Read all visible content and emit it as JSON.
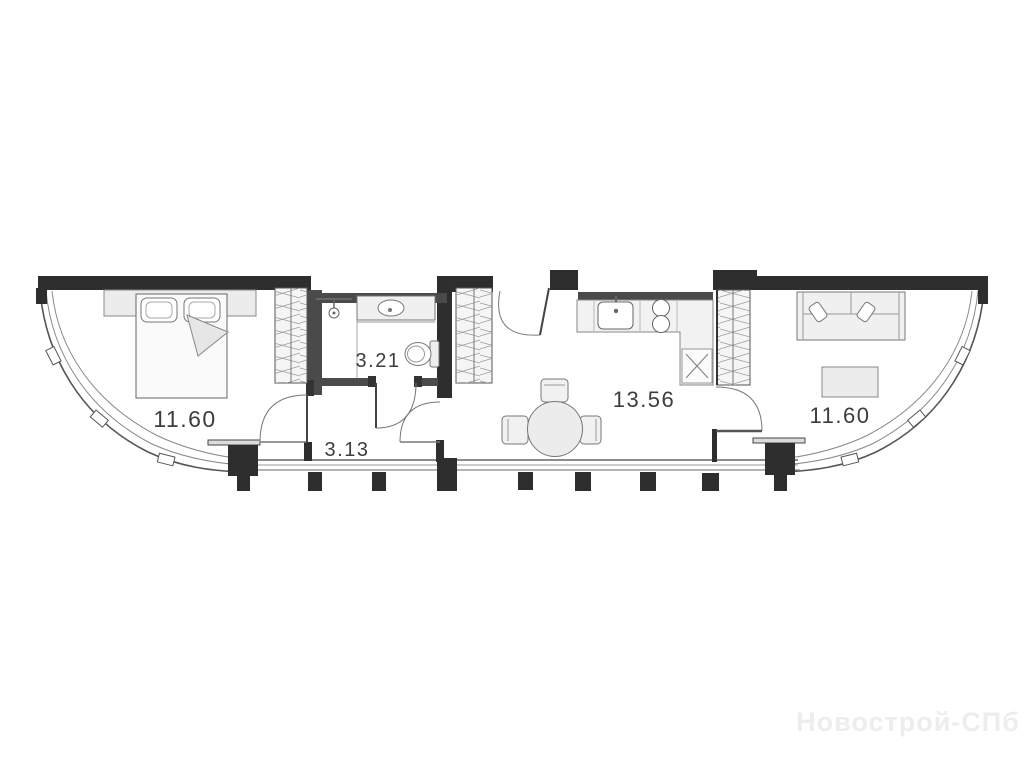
{
  "plan": {
    "type": "apartment-floor-plan",
    "rooms": [
      {
        "id": "bedroom",
        "area": "11.60"
      },
      {
        "id": "bathroom",
        "area": "3.21"
      },
      {
        "id": "hallway",
        "area": "3.13"
      },
      {
        "id": "kitchen_living",
        "area": "13.56"
      },
      {
        "id": "living_room",
        "area": "11.60"
      }
    ],
    "furniture": [
      "bed",
      "wardrobe",
      "shower",
      "vanity-sink",
      "toilet",
      "kitchen-counter",
      "kitchen-sink",
      "stove",
      "appliance-x",
      "dining-table",
      "chairs",
      "sofa",
      "coffee-table"
    ]
  },
  "labels": {
    "bedroom_area": "11.60",
    "bathroom_area": "3.21",
    "hallway_area": "3.13",
    "kitchen_area": "13.56",
    "living_area": "11.60"
  },
  "watermark": {
    "text": "Новострой-СПб"
  },
  "colors": {
    "wall_black": "#2e2e2e",
    "wall_gray": "#4a4a4a",
    "furniture_line": "#6e6e6e",
    "furniture_fill": "#f0f0f0",
    "label_color": "#3d3d3d",
    "watermark_color": "#ededed",
    "background": "#ffffff"
  }
}
